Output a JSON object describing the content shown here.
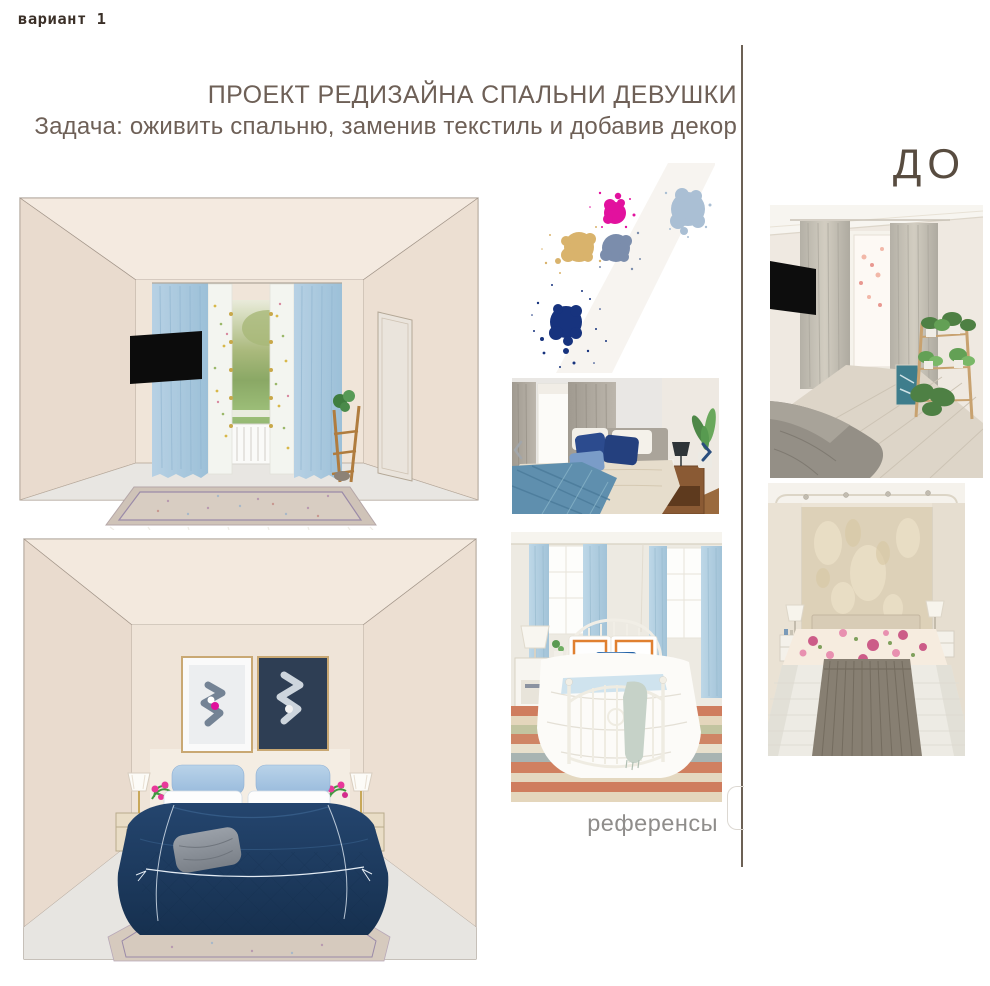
{
  "page": {
    "variant_label": "вариант 1",
    "title": "ПРОЕКТ РЕДИЗАЙНА СПАЛЬНИ ДЕВУШКИ",
    "subtitle": "Задача: оживить спальню, заменив текстиль и добавив декор",
    "before_label": "ДО",
    "references_label": "референсы"
  },
  "colors": {
    "title_text": "#6e6057",
    "variant_text": "#3a2f27",
    "before_text": "#584c40",
    "references_text": "#8f8d8b",
    "divider": "#6c6155",
    "curtain_blue": "#a9c7dd",
    "bedspread_navy": "#1d3a5f"
  },
  "palette": {
    "magenta": "#e2119e",
    "steel_blue": "#aabfd4",
    "tan": "#d9b36c",
    "gray_blue": "#7b8dac",
    "navy": "#17337e"
  },
  "carousel": {
    "prev_icon": "‹",
    "next_icon": "›"
  }
}
